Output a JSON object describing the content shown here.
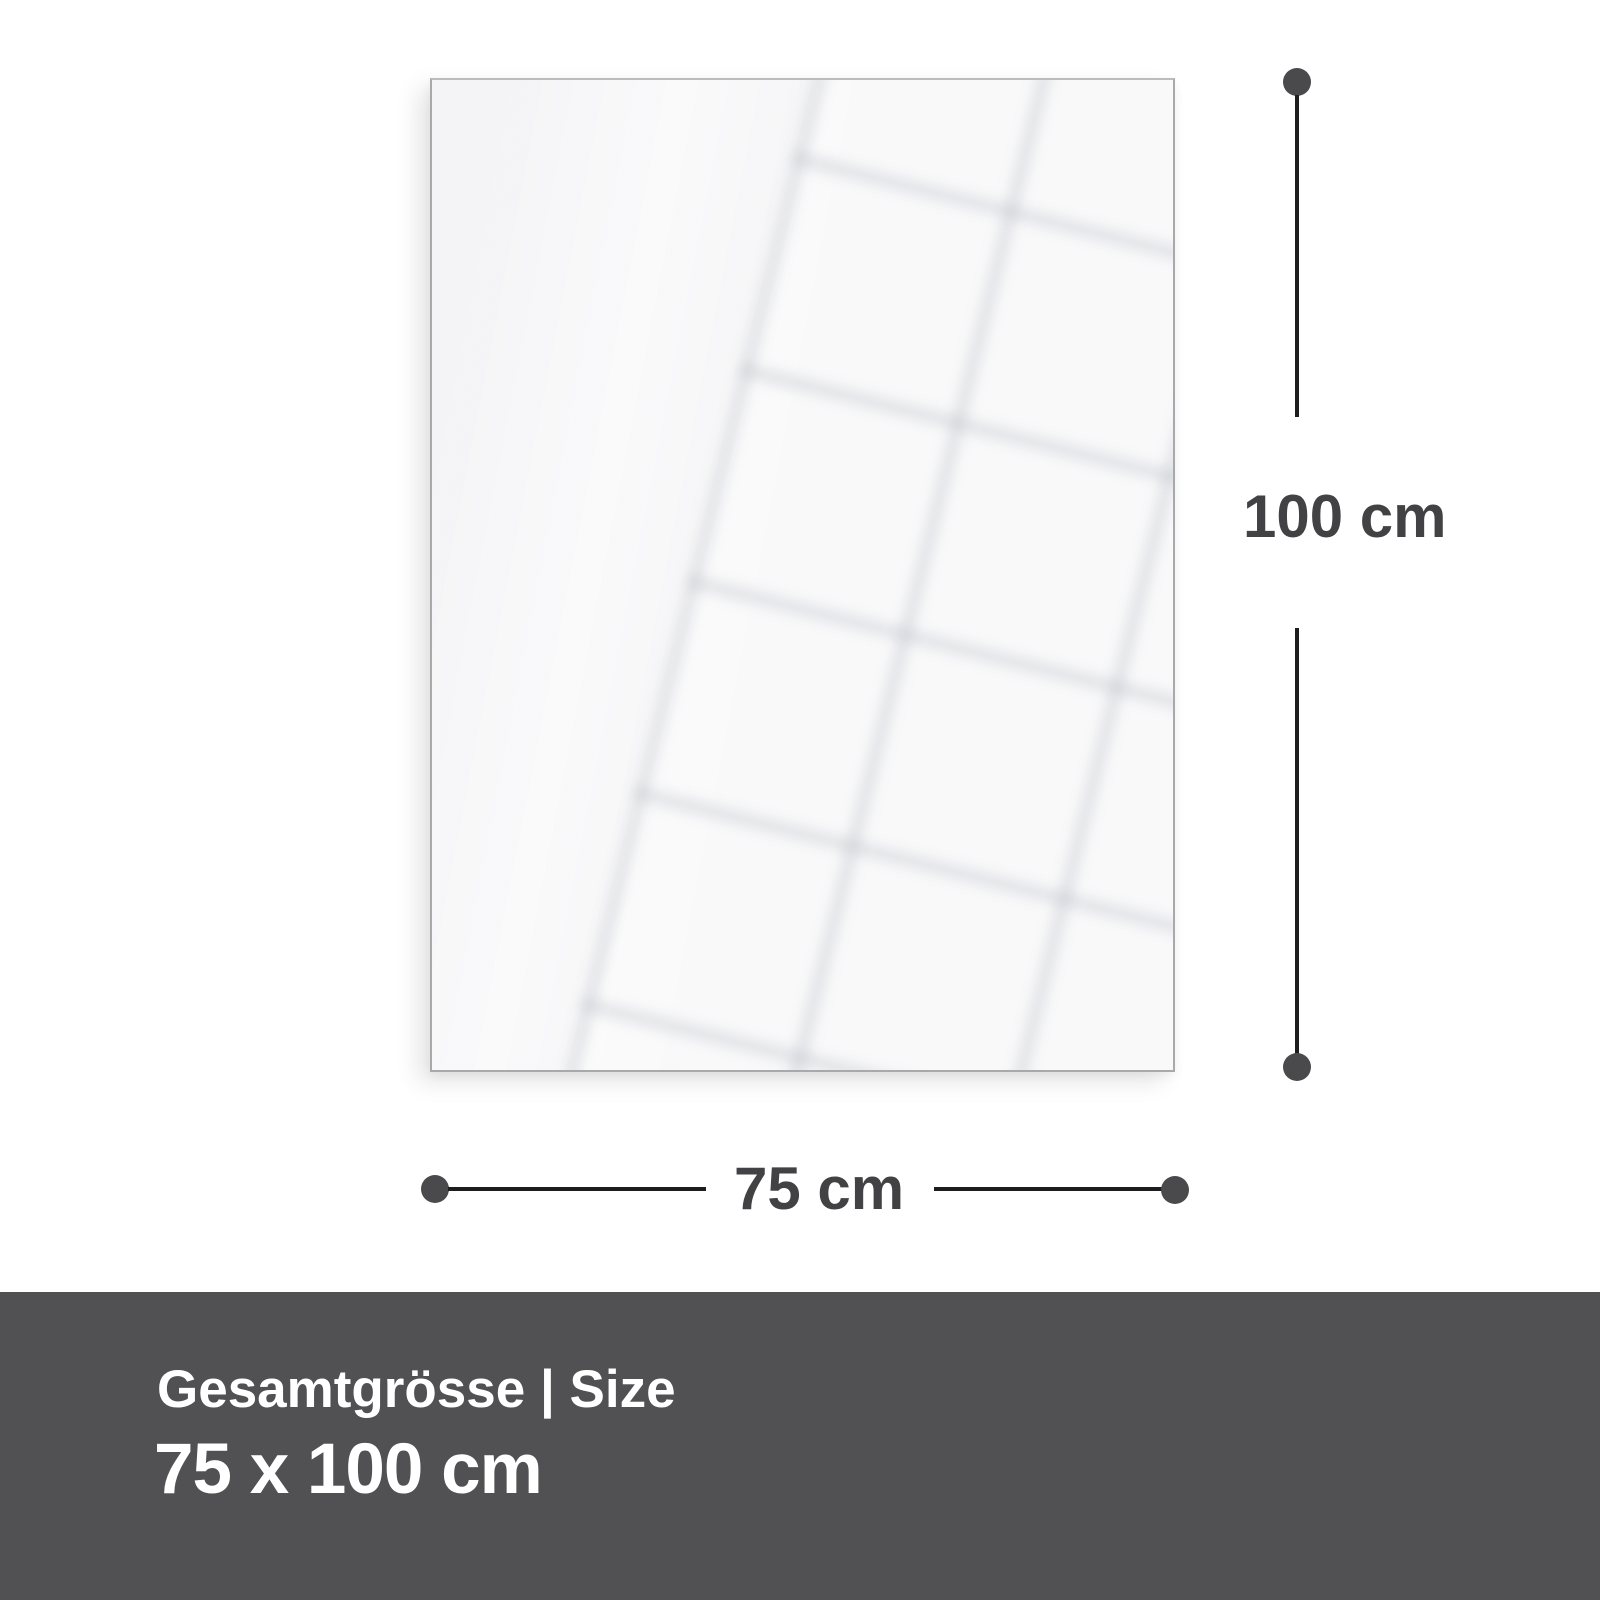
{
  "panel": {
    "description": "blank glossy panel with window reflection"
  },
  "dimensions": {
    "height_label": "100 cm",
    "width_label": "75 cm"
  },
  "footer": {
    "title": "Gesamtgrösse | Size",
    "size_value": "75 x 100 cm"
  },
  "colors": {
    "page_bg": "#ffffff",
    "panel_bg": "#f4f4f6",
    "panel_border": "#a9a9ab",
    "dimension_line": "#1d1d1f",
    "dimension_dot": "#4a4a4c",
    "dimension_text": "#424244",
    "footer_bg": "#515153",
    "footer_text": "#ffffff"
  }
}
